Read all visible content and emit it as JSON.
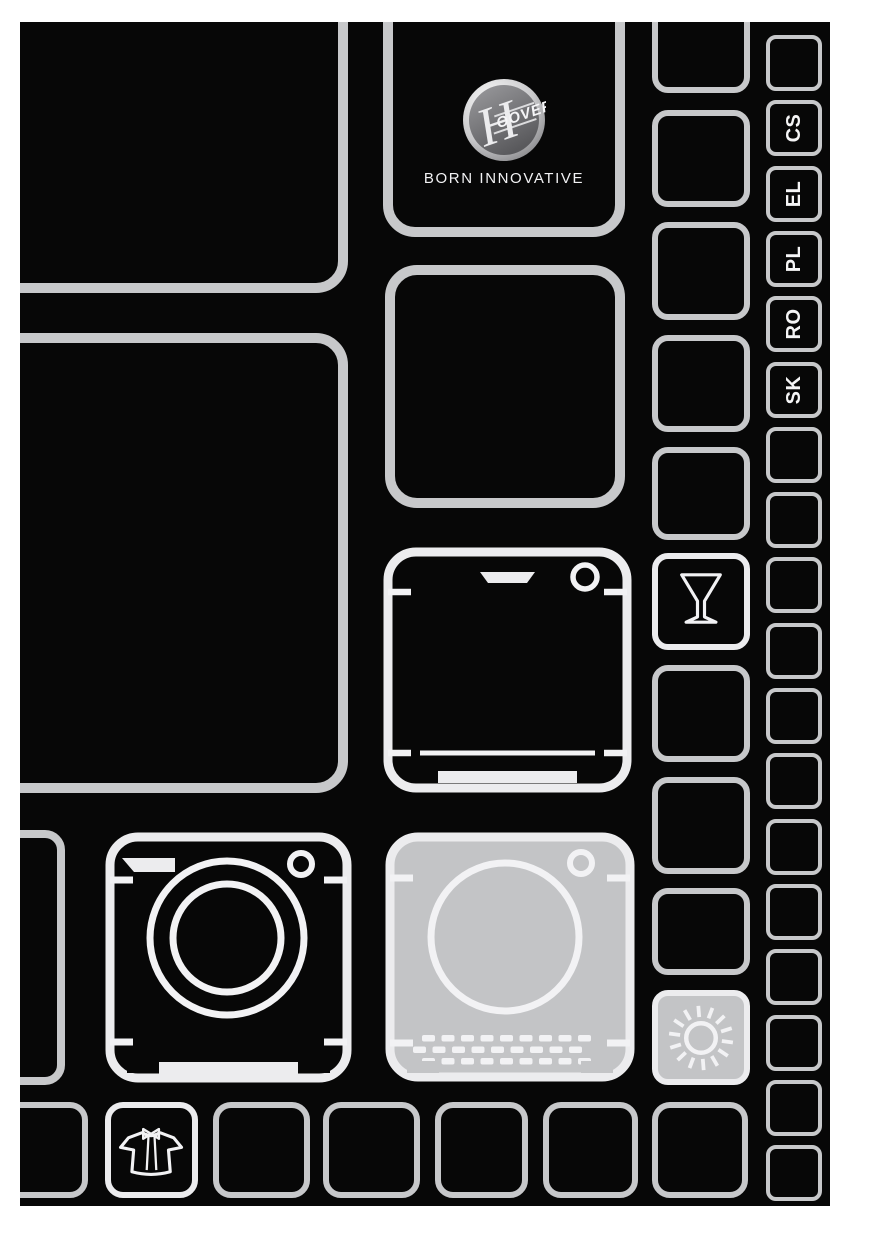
{
  "page": {
    "bg": "#ffffff",
    "canvas": "#070707",
    "grid_border": "#c7c8ca",
    "icon_border": "#ececee",
    "icon_stroke": "#f2f2f4",
    "tile_fill_gray": "#c3c4c6",
    "text_white": "#f5f5f6"
  },
  "brand": {
    "logo_initial": "H",
    "logo_rest": "OOVER",
    "tagline": "BORN INNOVATIVE"
  },
  "right_column": {
    "geometry": {
      "x": 746,
      "w": 56,
      "h": 56,
      "top": 13,
      "pitch": 65.3,
      "radius": 10,
      "border_w": 4.5
    },
    "items": [
      {
        "code": ""
      },
      {
        "code": "CS"
      },
      {
        "code": "EL"
      },
      {
        "code": "PL"
      },
      {
        "code": "RO"
      },
      {
        "code": "SK"
      },
      {
        "code": ""
      },
      {
        "code": ""
      },
      {
        "code": ""
      },
      {
        "code": ""
      },
      {
        "code": ""
      },
      {
        "code": ""
      },
      {
        "code": ""
      },
      {
        "code": ""
      },
      {
        "code": ""
      },
      {
        "code": ""
      },
      {
        "code": ""
      },
      {
        "code": ""
      }
    ]
  },
  "grid": {
    "tiles": [
      {
        "name": "tile-top-left-large",
        "x": -40,
        "y": -40,
        "w": 368,
        "h": 311,
        "r": 32,
        "bw": 10
      },
      {
        "name": "tile-mid-left-large",
        "x": -40,
        "y": 311,
        "w": 368,
        "h": 460,
        "r": 32,
        "bw": 10
      },
      {
        "name": "tile-center-empty",
        "x": 365,
        "y": 243,
        "w": 240,
        "h": 243,
        "r": 32,
        "bw": 10
      },
      {
        "name": "tile-dishwasher",
        "x": 363,
        "y": 525,
        "w": 249,
        "h": 246,
        "icon": "dishwasher"
      },
      {
        "name": "tile-washing-machine",
        "x": 85,
        "y": 810,
        "w": 247,
        "h": 251,
        "icon": "washing-machine"
      },
      {
        "name": "tile-tumble-dryer",
        "x": 365,
        "y": 810,
        "w": 250,
        "h": 250,
        "icon": "tumble-dryer"
      },
      {
        "name": "tile-left-sliver",
        "x": -24,
        "y": 808,
        "w": 69,
        "h": 255,
        "r": 20,
        "bw": 8
      },
      {
        "name": "tile-right-mid-1",
        "x": 632,
        "y": -40,
        "w": 98,
        "h": 111,
        "r": 16,
        "bw": 6
      },
      {
        "name": "tile-right-mid-2",
        "x": 632,
        "y": 88,
        "w": 98,
        "h": 97,
        "r": 16,
        "bw": 6
      },
      {
        "name": "tile-right-mid-3",
        "x": 632,
        "y": 200,
        "w": 98,
        "h": 98,
        "r": 16,
        "bw": 6
      },
      {
        "name": "tile-right-mid-4",
        "x": 632,
        "y": 313,
        "w": 98,
        "h": 97,
        "r": 16,
        "bw": 6
      },
      {
        "name": "tile-right-mid-5",
        "x": 632,
        "y": 425,
        "w": 98,
        "h": 93,
        "r": 16,
        "bw": 6
      },
      {
        "name": "tile-wine-glass",
        "x": 632,
        "y": 531,
        "w": 98,
        "h": 97,
        "r": 16,
        "bw": 6,
        "icon": "wine-glass"
      },
      {
        "name": "tile-right-mid-7",
        "x": 632,
        "y": 643,
        "w": 98,
        "h": 97,
        "r": 16,
        "bw": 6
      },
      {
        "name": "tile-right-mid-8",
        "x": 632,
        "y": 755,
        "w": 98,
        "h": 97,
        "r": 16,
        "bw": 6
      },
      {
        "name": "tile-right-mid-9",
        "x": 632,
        "y": 866,
        "w": 98,
        "h": 87,
        "r": 16,
        "bw": 6
      },
      {
        "name": "tile-sun",
        "x": 632,
        "y": 968,
        "w": 98,
        "h": 95,
        "r": 16,
        "bw": 6,
        "icon": "sun",
        "filled": true
      },
      {
        "name": "tile-bottom-sliver",
        "x": -40,
        "y": 1080,
        "w": 108,
        "h": 96,
        "r": 18,
        "bw": 6
      },
      {
        "name": "tile-shirt",
        "x": 85,
        "y": 1080,
        "w": 93,
        "h": 96,
        "r": 18,
        "bw": 6,
        "icon": "shirt"
      },
      {
        "name": "tile-bottom-3",
        "x": 193,
        "y": 1080,
        "w": 97,
        "h": 96,
        "r": 18,
        "bw": 6
      },
      {
        "name": "tile-bottom-4",
        "x": 303,
        "y": 1080,
        "w": 97,
        "h": 96,
        "r": 18,
        "bw": 6
      },
      {
        "name": "tile-bottom-5",
        "x": 415,
        "y": 1080,
        "w": 93,
        "h": 96,
        "r": 18,
        "bw": 6
      },
      {
        "name": "tile-bottom-6",
        "x": 523,
        "y": 1080,
        "w": 95,
        "h": 96,
        "r": 18,
        "bw": 6
      },
      {
        "name": "tile-bottom-7",
        "x": 632,
        "y": 1080,
        "w": 96,
        "h": 96,
        "r": 18,
        "bw": 6
      }
    ]
  }
}
